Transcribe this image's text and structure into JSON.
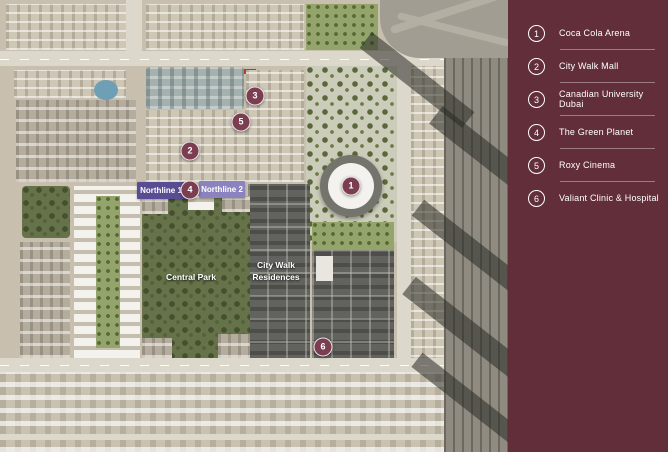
{
  "legend": {
    "panel_color": "#622e3a",
    "items": [
      {
        "number": "1",
        "label": "Coca Cola Arena"
      },
      {
        "number": "2",
        "label": "City Walk Mall"
      },
      {
        "number": "3",
        "label": "Canadian University Dubai"
      },
      {
        "number": "4",
        "label": "The Green Planet"
      },
      {
        "number": "5",
        "label": "Roxy Cinema"
      },
      {
        "number": "6",
        "label": "Valiant Clinic & Hospital"
      }
    ]
  },
  "map": {
    "area_labels": {
      "northline1": "Northline 1",
      "northline2": "Northline 2",
      "central_park": "Central Park",
      "city_walk_line1": "City Walk",
      "city_walk_line2": "Residences"
    },
    "markers": [
      {
        "number": "1",
        "x": 351,
        "y": 186
      },
      {
        "number": "2",
        "x": 190,
        "y": 151
      },
      {
        "number": "3",
        "x": 255,
        "y": 96
      },
      {
        "number": "4",
        "x": 190,
        "y": 190
      },
      {
        "number": "5",
        "x": 241,
        "y": 122
      },
      {
        "number": "6",
        "x": 323,
        "y": 347
      }
    ],
    "colors": {
      "marker": "#7b3e50",
      "northline1_chip": "#584d93",
      "northline2_chip": "#8b82c0"
    }
  }
}
